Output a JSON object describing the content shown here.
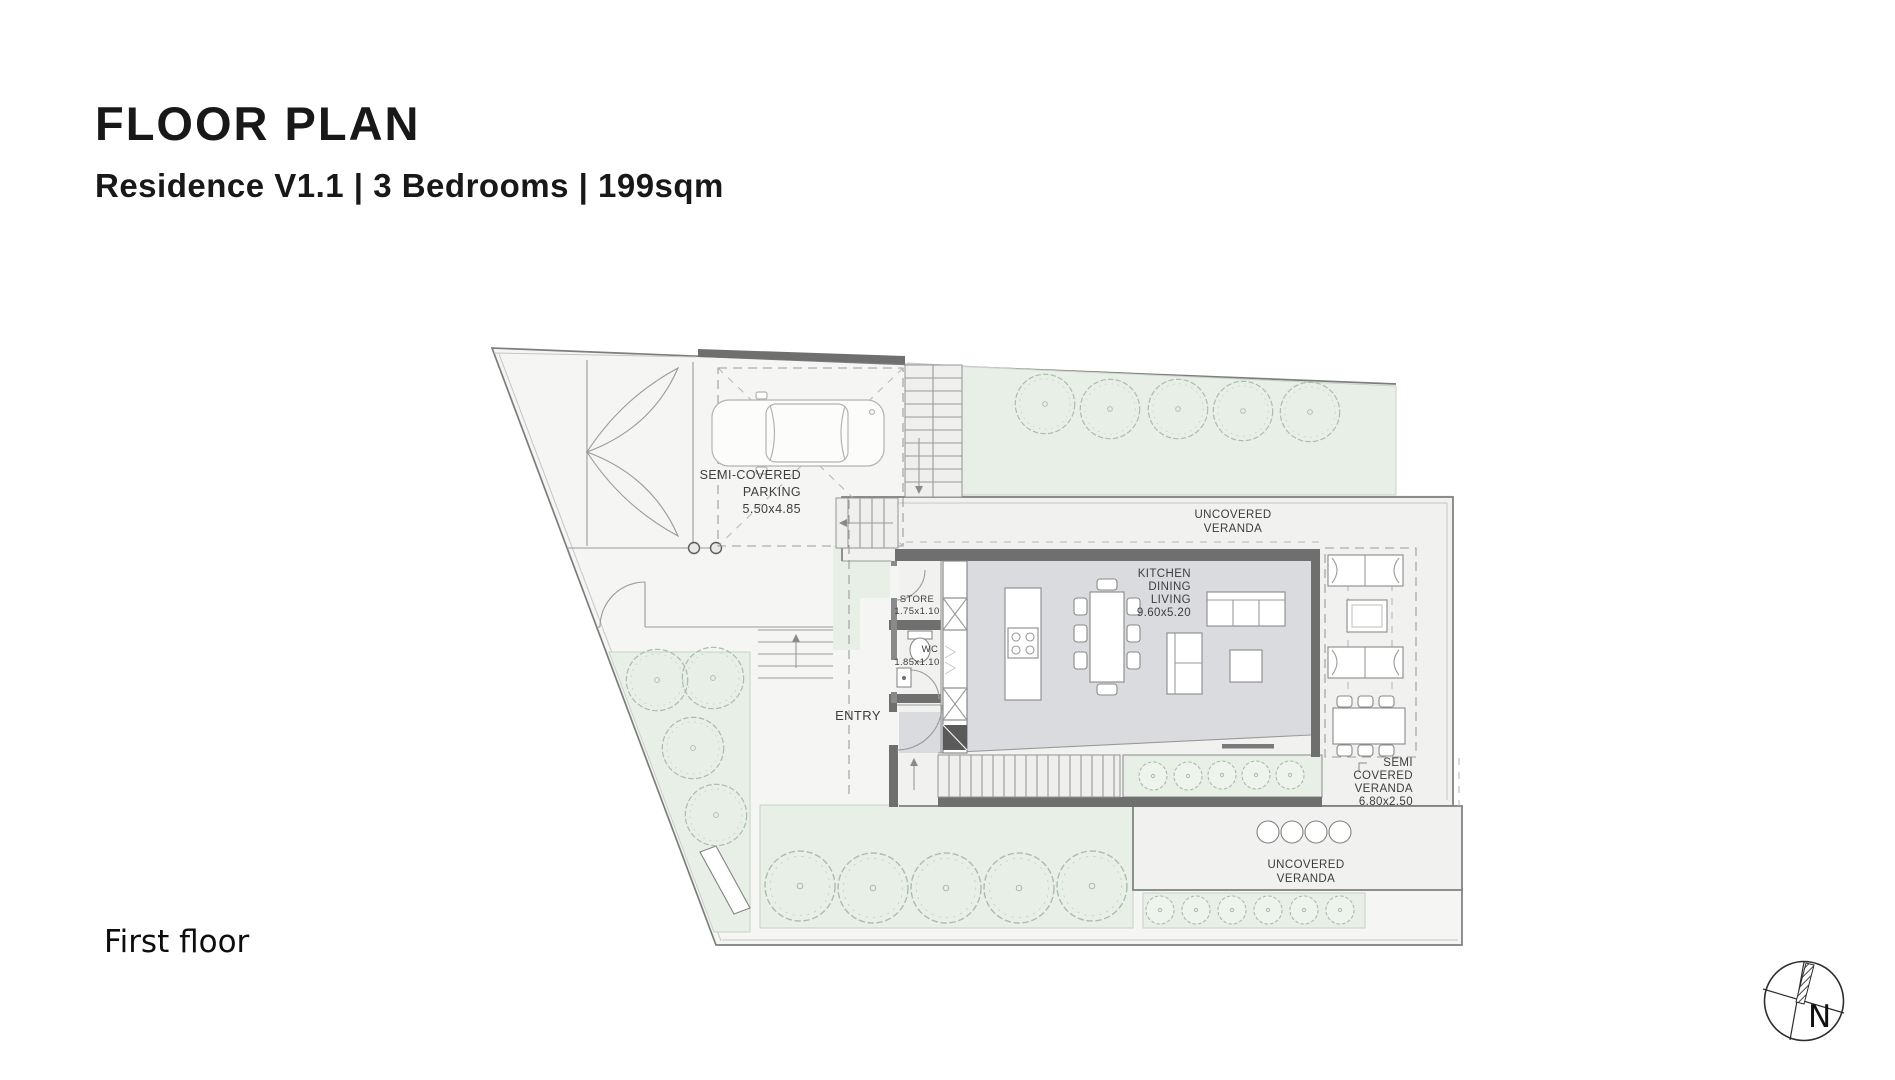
{
  "header": {
    "title": "FLOOR PLAN",
    "subtitle": "Residence V1.1 | 3 Bedrooms | 199sqm"
  },
  "footer": {
    "floor_label": "First floor"
  },
  "compass": {
    "north_label": "N"
  },
  "plan": {
    "parking": {
      "line1": "SEMI-COVERED",
      "line2": "PARKING",
      "dims": "5.50x4.85"
    },
    "veranda_top": {
      "line1": "UNCOVERED",
      "line2": "VERANDA"
    },
    "living": {
      "line1": "KITCHEN",
      "line2": "DINING",
      "line3": "LIVING",
      "dims": "9.60x5.20"
    },
    "store": {
      "name": "STORE",
      "dims": "1.75x1.10"
    },
    "wc": {
      "name": "WC",
      "dims": "1.85x1.10"
    },
    "entry": {
      "name": "ENTRY"
    },
    "veranda_semi": {
      "line1": "SEMI",
      "line2": "COVERED",
      "line3": "VERANDA",
      "dims": "6.80x2.50"
    },
    "veranda_bottom": {
      "line1": "UNCOVERED",
      "line2": "VERANDA"
    }
  },
  "colors": {
    "plot_bg": "#f5f5f3",
    "slab_bg": "#f1f1ef",
    "garden_green": "#e7efe7",
    "wall_dark": "#6f6f6f",
    "floor_gray": "#d9dbdf",
    "line_gray": "#9a9a9a",
    "text_dark": "#3d3d3d"
  }
}
